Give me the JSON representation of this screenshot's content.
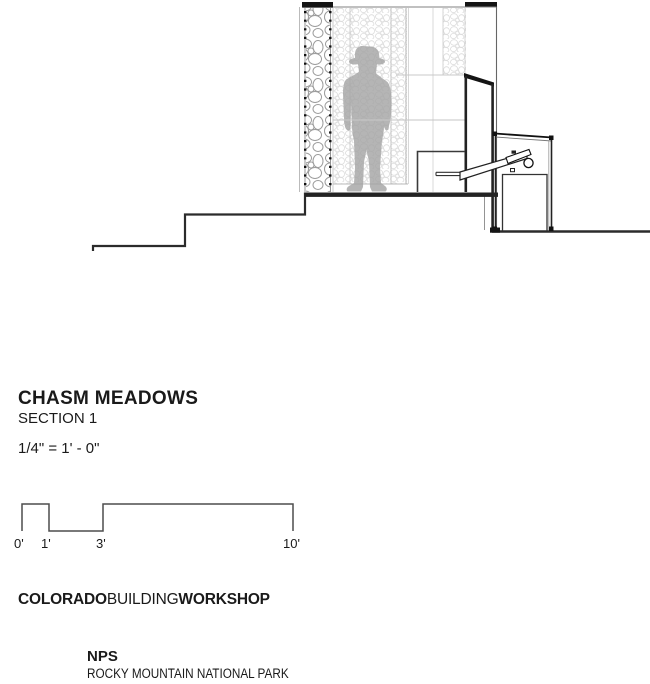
{
  "title_block": {
    "title": "CHASM MEADOWS",
    "subtitle": "SECTION 1",
    "scale_note": "1/4\" = 1' - 0\""
  },
  "scale_bar": {
    "tick_0": "0'",
    "tick_1": "1'",
    "tick_3": "3'",
    "tick_10": "10'"
  },
  "credits": {
    "studio_bold_1": "COLORADO",
    "studio_regular": "BUILDING",
    "studio_bold_2": "WORKSHOP",
    "client": "NPS",
    "client_subtitle": "ROCKY MOUNTAIN NATIONAL PARK"
  },
  "drawing": {
    "icons": {
      "figure": "hiker-silhouette",
      "wall": "gabion-stone-wall",
      "equipment": "service-box-with-chute"
    },
    "colors": {
      "line_black": "#1c1c1c",
      "line_medium": "#555555",
      "line_faint": "#c8c8c8",
      "stone_outline": "#9c9c9c",
      "stone_fine": "#dcdcdc",
      "figure_gray": "#a5a5a5",
      "floor_black": "#232323"
    }
  }
}
